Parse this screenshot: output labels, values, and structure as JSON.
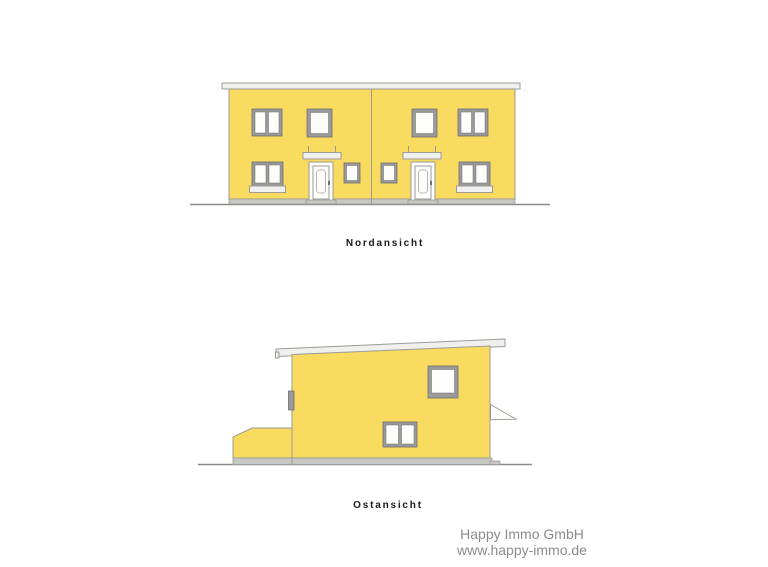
{
  "page": {
    "background": "#ffffff",
    "description_labels": {
      "north_view": "Nordansicht",
      "east_view": "Ostansicht"
    }
  },
  "colors": {
    "page_bg": "#ffffff",
    "facade_yellow": "#f8db5f",
    "outline_gray": "#9b9b97",
    "frame_gray": "#9a9a9a",
    "frame_dark": "#6e6e6e",
    "pane_white": "#fdfdfb",
    "roof_white": "#f0f0ee",
    "plinth_gray": "#c7c7c3",
    "ground_gray": "#8a8a8a",
    "label_black": "#1a1a1a",
    "watermark_gray": "#8c8c8c"
  },
  "drawings": [
    {
      "id": "north",
      "label": "Nordansicht"
    },
    {
      "id": "east",
      "label": "Ostansicht"
    }
  ],
  "watermark": {
    "line1": "Happy Immo GmbH",
    "line2": "www.happy-immo.de"
  }
}
